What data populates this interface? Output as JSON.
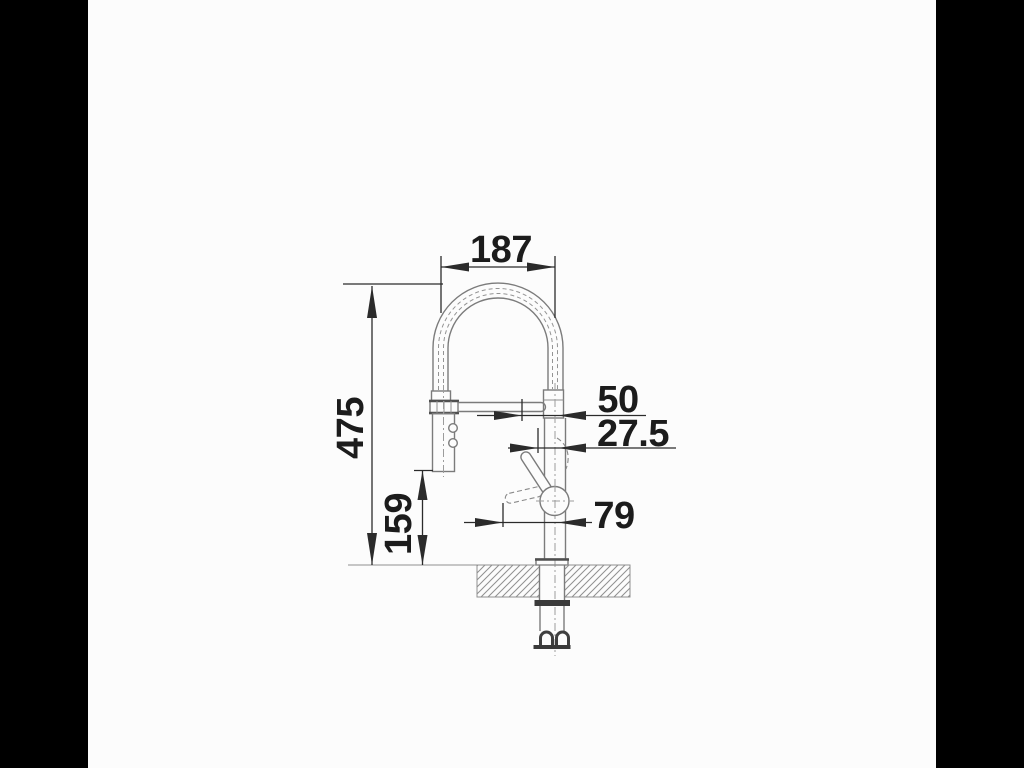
{
  "drawing": {
    "kind": "technical-dimension-drawing",
    "subject": "kitchen faucet with high spring arc spout, pull-down spray head, lever handle, counter cross-section and supply hoses",
    "background_color": "#000000",
    "canvas_color": "#fcfcfc",
    "line_color": "#7b7b7b",
    "dimension_color": "#1c1c1c",
    "dimensions": [
      {
        "id": "arc-width",
        "label": "187",
        "orientation": "horizontal"
      },
      {
        "id": "total-height",
        "label": "475",
        "orientation": "vertical"
      },
      {
        "id": "outlet-height",
        "label": "159",
        "orientation": "vertical"
      },
      {
        "id": "offset-50",
        "label": "50",
        "orientation": "horizontal"
      },
      {
        "id": "offset-27-5",
        "label": "27.5",
        "orientation": "horizontal"
      },
      {
        "id": "handle-projection",
        "label": "79",
        "orientation": "horizontal"
      }
    ]
  }
}
